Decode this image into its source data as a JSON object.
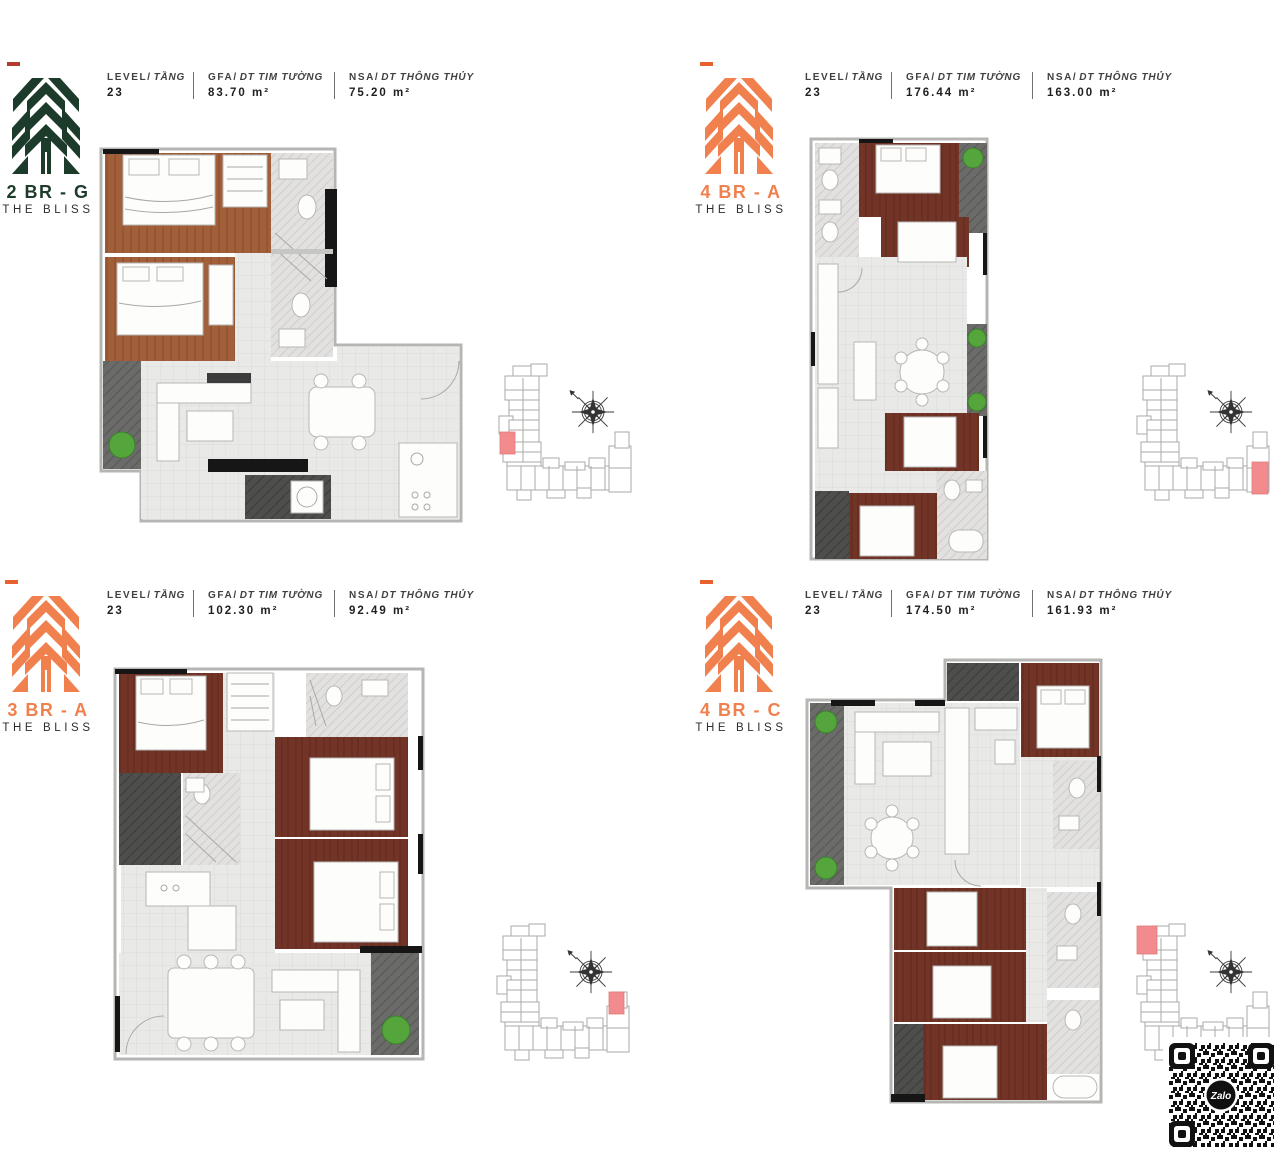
{
  "project": "THE BLISS",
  "qr": {
    "label": "Zalo"
  },
  "colors": {
    "logo_green": "#1d3b2b",
    "logo_orange": "#f0814e",
    "accent_dash_red": "#b23a30",
    "accent_dash_orange": "#e8602f",
    "keyplan_highlight": "#f28b8d",
    "wood_light": "#a2603a",
    "wood_dark": "#713426",
    "balcony_gray": "#6b6b69",
    "tile_gray": "#e9e9e7"
  },
  "header_labels": {
    "level": "LEVEL/",
    "level_vn": "TẦNG",
    "gfa": "GFA/",
    "gfa_vn": "DT TIM TƯỜNG",
    "nsa": "NSA/",
    "nsa_vn": "DT THÔNG THỦY"
  },
  "units": [
    {
      "id": "2br-g",
      "name": "2 BR - G",
      "project": "THE BLISS",
      "accent": "#1d3b2b",
      "dash": "#b23a30",
      "level_value": "23",
      "gfa_value": "83.70 m²",
      "nsa_value": "75.20 m²"
    },
    {
      "id": "4br-a",
      "name": "4 BR - A",
      "project": "THE BLISS",
      "accent": "#f0814e",
      "dash": "#e8602f",
      "level_value": "23",
      "gfa_value": "176.44 m²",
      "nsa_value": "163.00 m²"
    },
    {
      "id": "3br-a",
      "name": "3 BR - A",
      "project": "THE BLISS",
      "accent": "#f0814e",
      "dash": "#e8602f",
      "level_value": "23",
      "gfa_value": "102.30 m²",
      "nsa_value": "92.49 m²"
    },
    {
      "id": "4br-c",
      "name": "4 BR - C",
      "project": "THE BLISS",
      "accent": "#f0814e",
      "dash": "#e8602f",
      "level_value": "23",
      "gfa_value": "174.50 m²",
      "nsa_value": "161.93 m²"
    }
  ]
}
